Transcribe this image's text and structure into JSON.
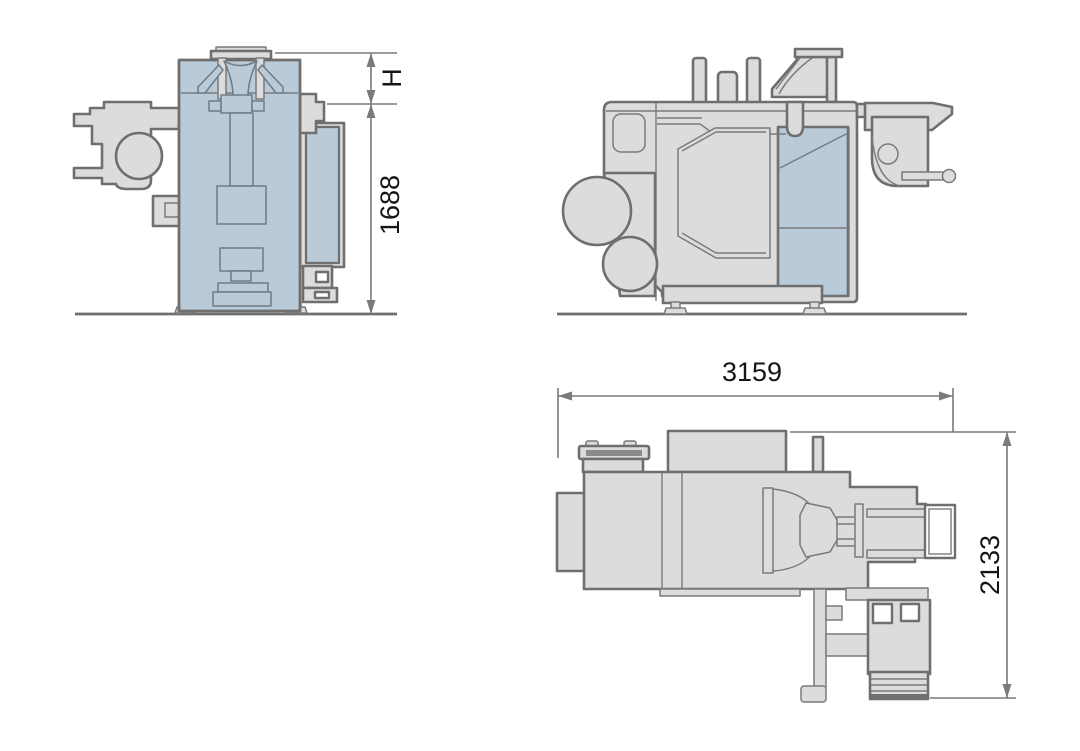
{
  "drawing": {
    "kind": "machine-dimension-drawing",
    "dimensions": {
      "height_upper": "H",
      "height_main": "1688",
      "length_overall": "3159",
      "depth_overall": "2133"
    },
    "colors": {
      "background": "#ffffff",
      "machine_fill": "#dcdcdc",
      "highlight_fill": "#b9cad8",
      "outline": "#6f6f6f",
      "inner_line": "#7a7a7a",
      "dimension_line": "#7a7a7a",
      "dimension_text": "#161616"
    }
  }
}
